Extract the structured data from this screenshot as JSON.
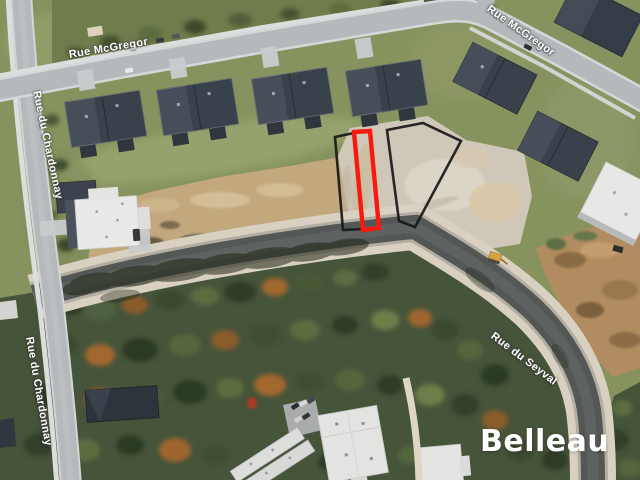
{
  "streets": {
    "mcgregor": {
      "label": "Rue McGregor"
    },
    "chardonnay": {
      "label": "Rue du Chardonnay"
    },
    "seyval": {
      "label": "Rue du Seyval"
    }
  },
  "lots": {
    "featured": {
      "outline_color": "#f8190f"
    },
    "adjacent": {
      "outline_color": "#181818"
    }
  },
  "watermark": {
    "brand": "Belleau",
    "color": "#ffffff"
  }
}
